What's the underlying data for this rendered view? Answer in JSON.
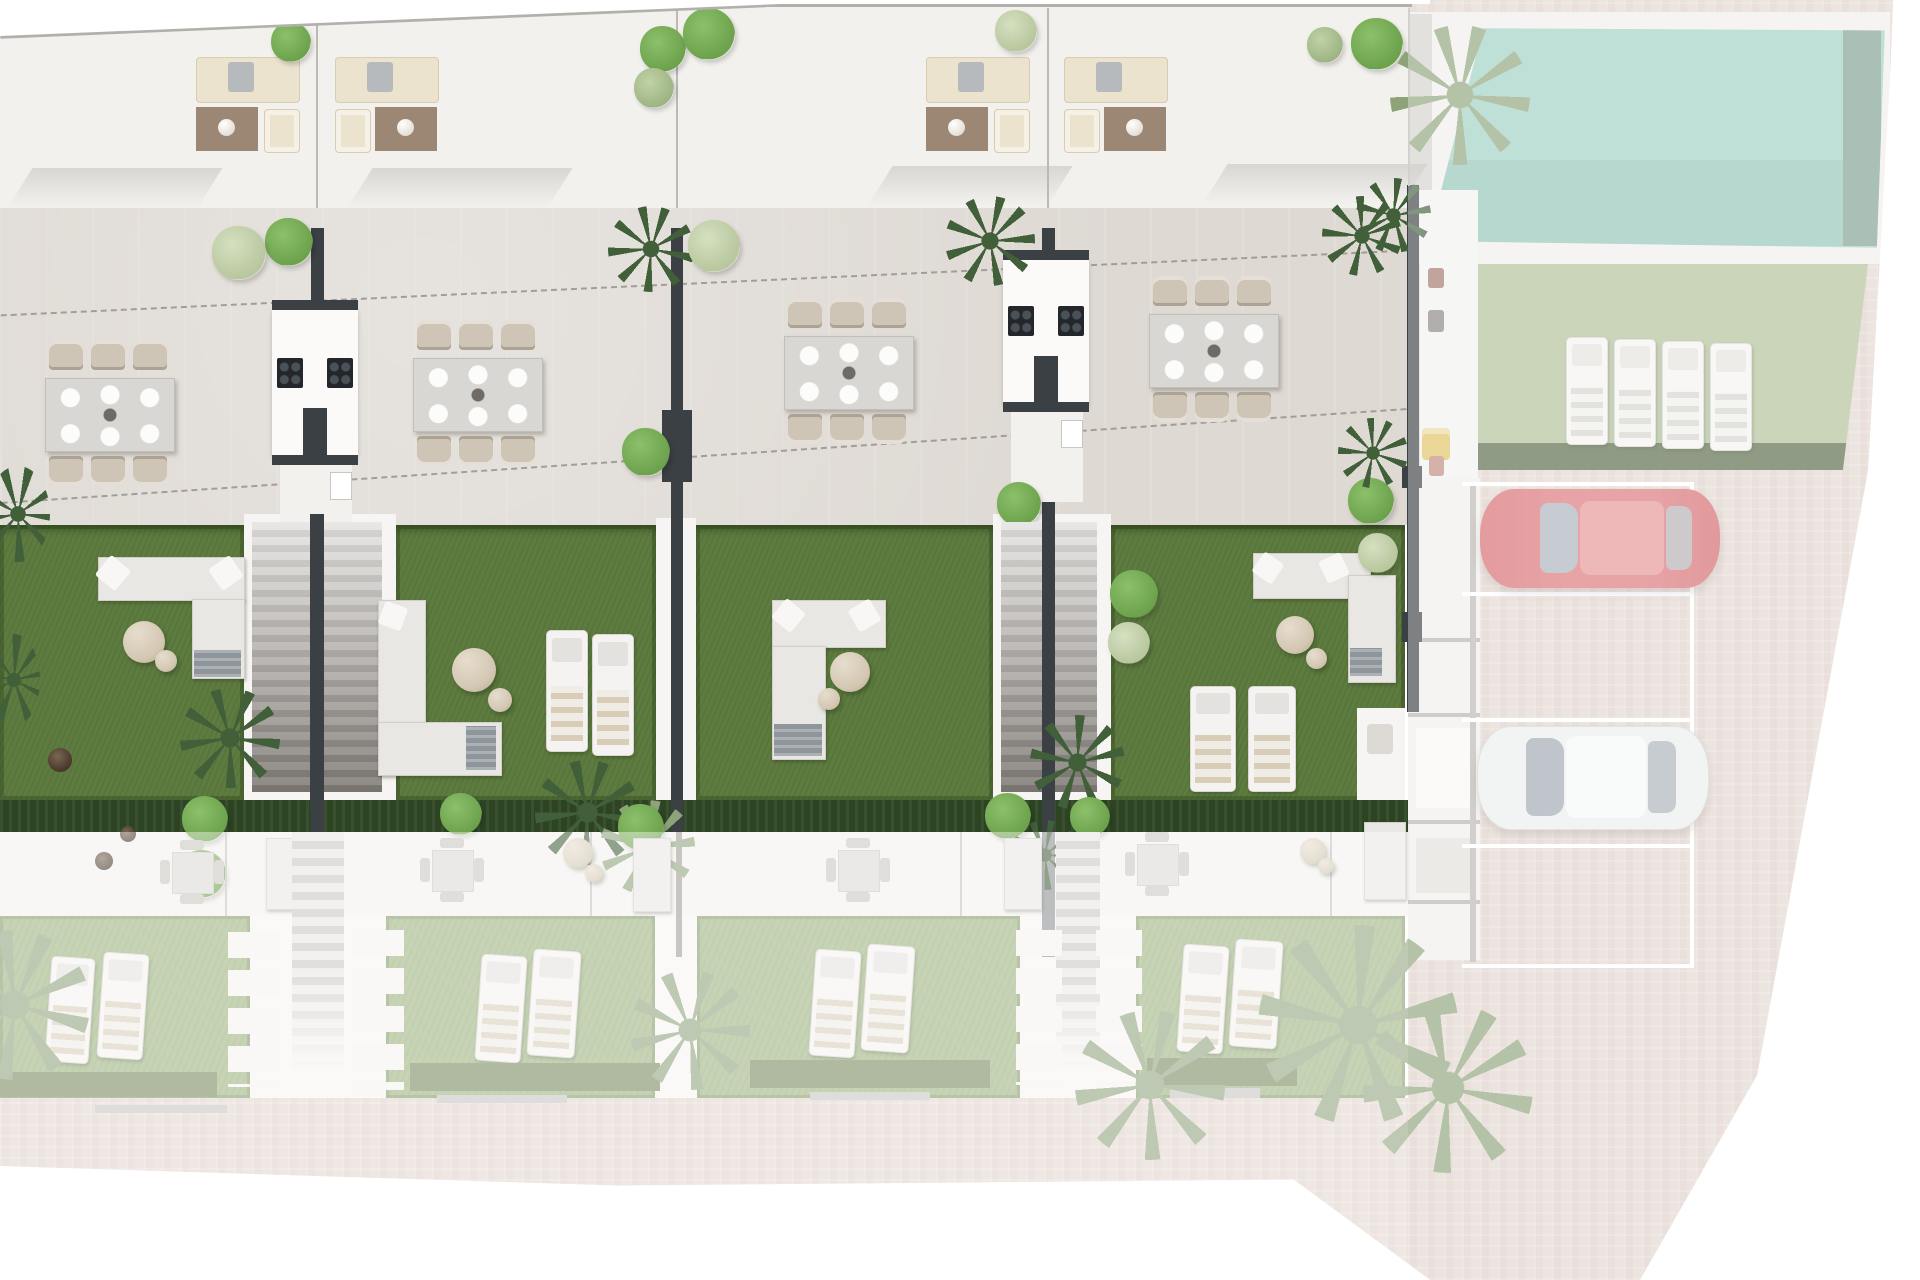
{
  "scene": {
    "type": "architectural-site-plan",
    "title": "Townhouse development – top-down site plan render",
    "regions": {
      "roof_terraces": "Roof terraces with outdoor lounge sets",
      "dining_terraces": "Paved terraces with dining sets and shared outdoor kitchens",
      "gardens": "Private lawned gardens with sofas, loungers and staircases",
      "lower_level": "Lower-level interiors and gardens",
      "pool": "Swimming pool",
      "sunbathing_lawn": "Communal lawn with four sun loungers",
      "parking": "Parking bays with two parked cars",
      "driveway": "Brick-paved driveway"
    }
  },
  "inventory": {
    "townhouse_units": 4,
    "roof_lounge_sets": 4,
    "dining_sets": 4,
    "chairs_per_dining_set": 6,
    "outdoor_kitchens": 2,
    "garden_staircases": 2,
    "garden_sofa_sets": 4,
    "garden_sun_loungers": 6,
    "lower_garden_sun_loungers": 8,
    "lawn_sun_loungers": 4,
    "parking_bays": 4,
    "cars": 2
  },
  "cars": [
    {
      "name": "red-car",
      "color": "#db6f72"
    },
    {
      "name": "white-car",
      "color": "#edefef"
    }
  ],
  "colors": {
    "bg": "#ffffff",
    "roof": "#f3f1ee",
    "terrace": "#ded9d3",
    "terraceline": "#b3b0ac",
    "dash": "#a29d97",
    "grass": "#5e7c40",
    "hedge": "#2d4423",
    "lowergrass": "#9db37e",
    "interior": "#f4f2ef",
    "pavement": "#e3d6cf",
    "pool": "#9fd0c3",
    "poolhedge": "#7f9f8f",
    "lawn": "#b0bf97",
    "lawnhedge": "#566845",
    "wall": "#3b4045",
    "whitestruct": "#f6f5f3",
    "stairA": "#cfcbc7",
    "stairB": "#a5a19d",
    "cream": "#ece3cf",
    "rug": "#9c8775",
    "cooktop": "#23272b",
    "tablegray": "#d9d7d3",
    "chairbeige": "#cfc5b6",
    "pouf": "#d3c7b2",
    "matgray": "#8e969b",
    "deckgray": "#d5d2ce",
    "glass": "#a9b2b9",
    "potbrown": "#4e3e30"
  }
}
